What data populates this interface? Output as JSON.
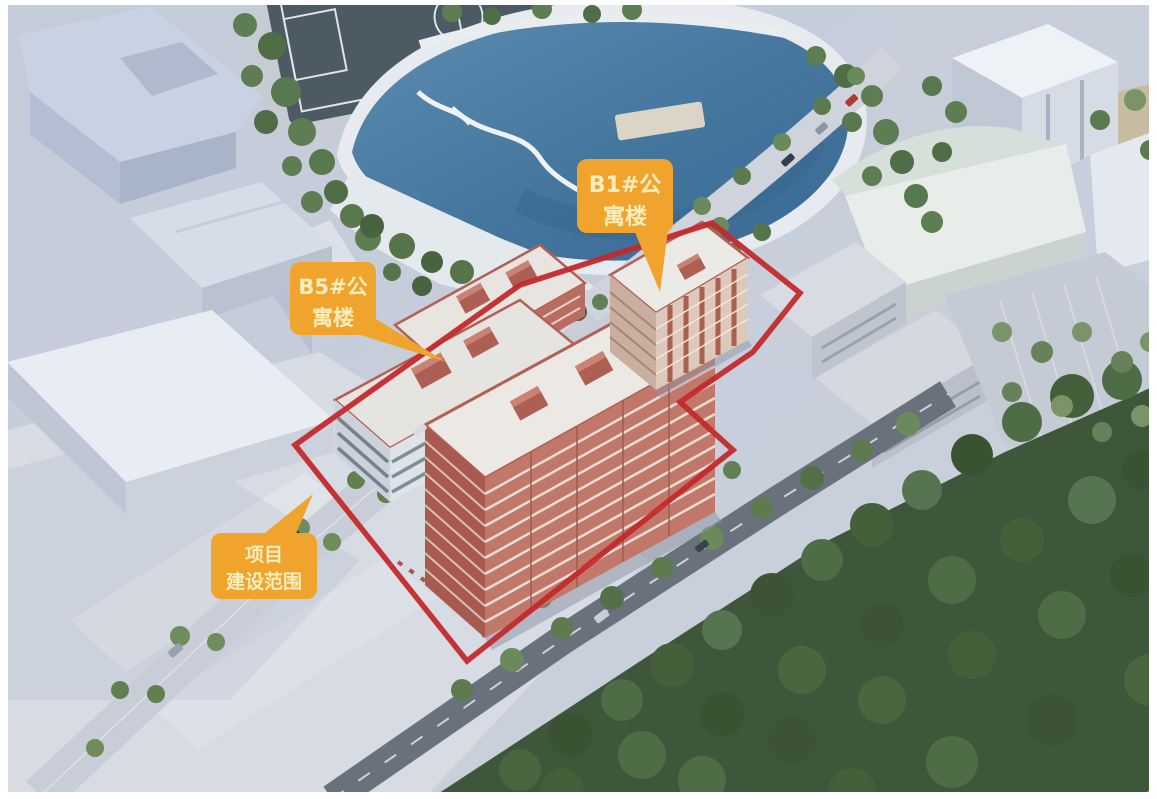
{
  "annotations": {
    "b1_label": {
      "line1": "B1#公",
      "line2": "寓楼"
    },
    "b5_label": {
      "line1": "B5#公",
      "line2": "寓楼"
    },
    "scope_label": {
      "line1": "项目",
      "line2": "建设范围"
    }
  },
  "colors": {
    "callout_bg": "#F0A42E",
    "callout_text": "#F9EDBE",
    "boundary_red": "#C3292B",
    "lake_blue": "#4A7CA3",
    "brick_red": "#B4655A"
  }
}
